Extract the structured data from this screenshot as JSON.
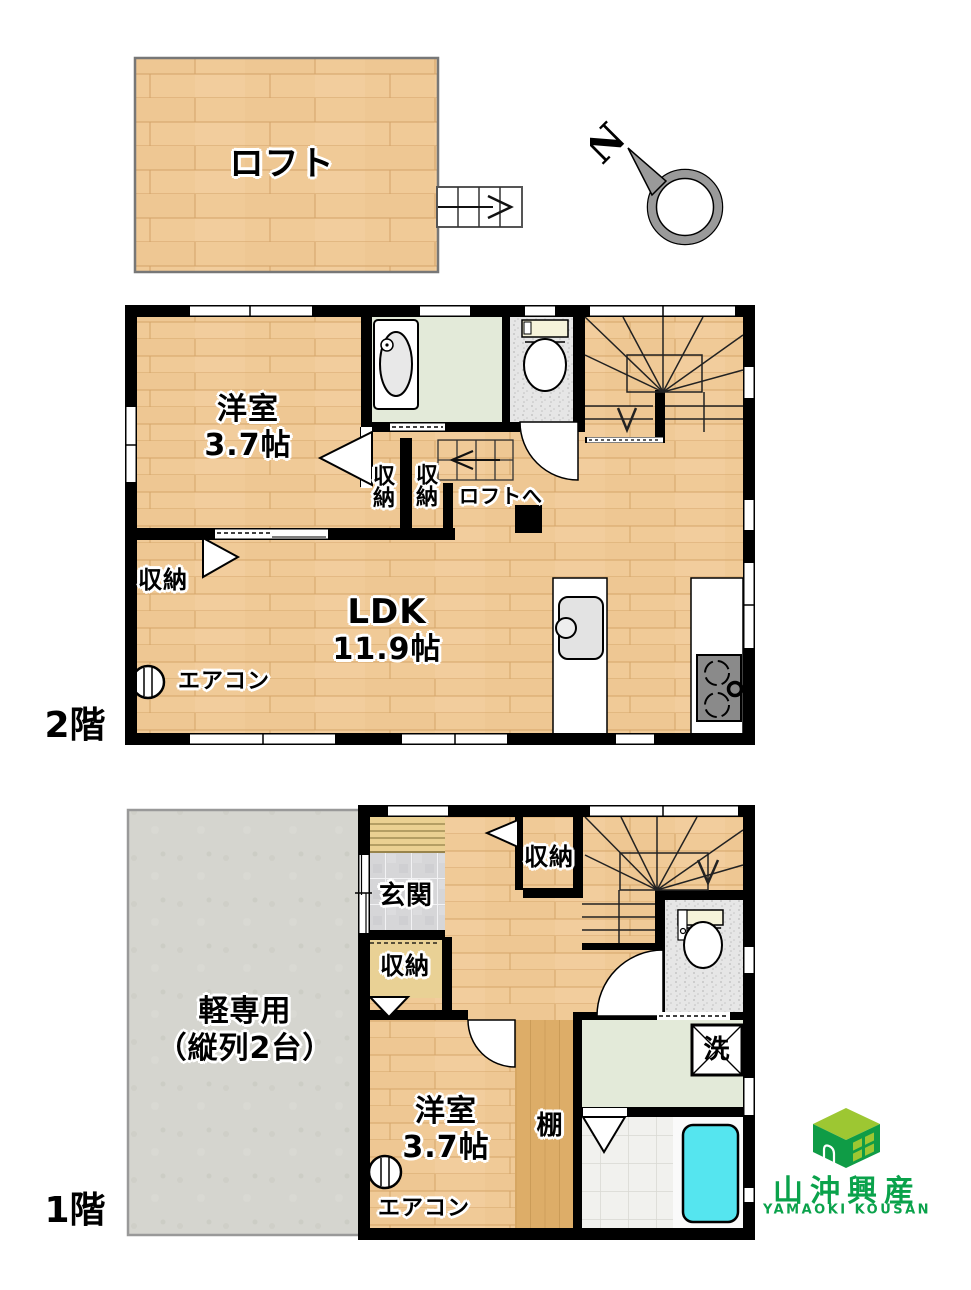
{
  "compass": {
    "north": "N"
  },
  "loft": {
    "name": "ロフト"
  },
  "floor2": {
    "label": "2階",
    "western_room": {
      "name": "洋室",
      "size": "3.7帖"
    },
    "closet_center_left": "収納",
    "closet_center_right": "収納",
    "closet_left": "収納",
    "to_loft": "ロフトへ",
    "ldk": {
      "name": "LDK",
      "size": "11.9帖"
    },
    "aircon": "エアコン"
  },
  "floor1": {
    "label": "1階",
    "parking": {
      "line1": "軽専用",
      "line2": "（縦列2台）"
    },
    "entrance": "玄関",
    "closet_top": "収納",
    "closet_left": "収納",
    "western_room": {
      "name": "洋室",
      "size": "3.7帖"
    },
    "shelf": "棚",
    "laundry": "洗",
    "aircon": "エアコン"
  },
  "logo": {
    "company": "山沖興産",
    "romaji": "YAMAOKI KOUSAN",
    "green": "#0f9c46",
    "light_green": "#9dc732",
    "text_green": "#0aa24b"
  },
  "colors": {
    "wood_floor": "#f0ca97",
    "wall": "#000000",
    "washroom_green": "#e3ead9",
    "entrance_tile_gray": "#d8d8da",
    "bathtub_cyan": "#55e5ef",
    "parking_concrete": "#d5d5cf"
  }
}
